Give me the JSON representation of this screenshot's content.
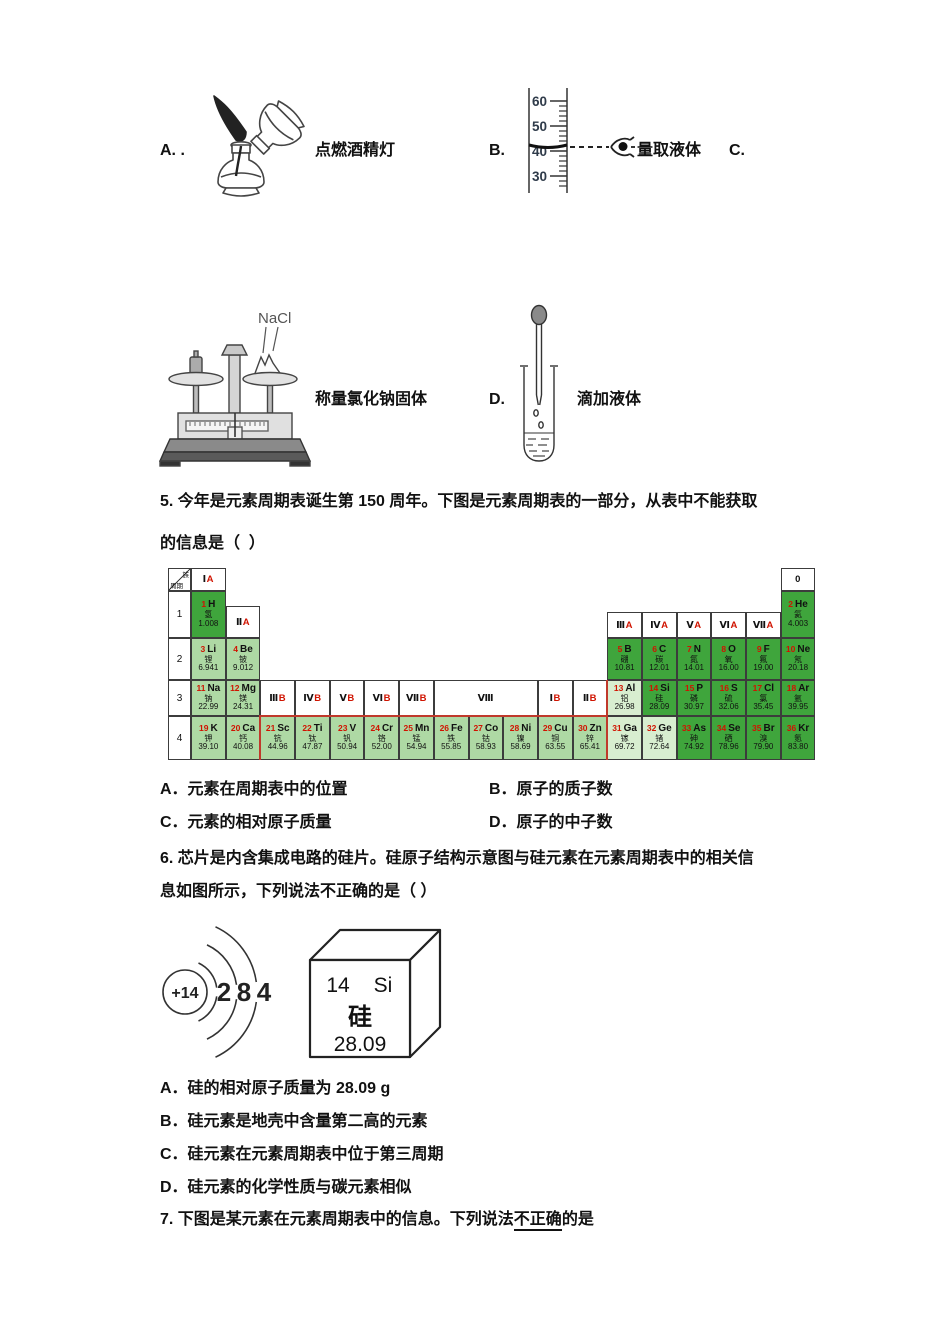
{
  "instrument_row": {
    "option_a_label": "A. .",
    "lamp_caption": "点燃酒精灯",
    "option_b_label": "B.",
    "cylinder_scale": [
      "60",
      "50",
      "40",
      "30"
    ],
    "cylinder_caption": "量取液体",
    "option_c_label": "C.",
    "balance_chemical": "NaCl",
    "balance_caption": "称量氯化钠固体",
    "option_d_label": "D.",
    "dropper_caption": "滴加液体"
  },
  "q5": {
    "stem_line1": "5. 今年是元素周期表诞生第 150 周年。下图是元素周期表的一部分，从表中不能获取",
    "stem_line2": "的信息是（  ）",
    "option_a": "A．元素在周期表中的位置",
    "option_b": "B．原子的质子数",
    "option_c": "C．元素的相对原子质量",
    "option_d": "D．原子的中子数"
  },
  "periodic_table": {
    "corner_top": "族",
    "corner_bottom": "周期",
    "periods": [
      "1",
      "2",
      "3",
      "4"
    ],
    "headers": [
      {
        "label": "Ⅰ",
        "sub": "A",
        "row": "top",
        "col": 1
      },
      {
        "label": "0",
        "row": "top",
        "col": 18
      },
      {
        "label": "Ⅱ",
        "sub": "A",
        "row": "p1",
        "col": 2
      },
      {
        "label": "Ⅲ",
        "sub": "A",
        "row": "p1",
        "col": 13
      },
      {
        "label": "Ⅳ",
        "sub": "A",
        "row": "p1",
        "col": 14
      },
      {
        "label": "Ⅴ",
        "sub": "A",
        "row": "p1",
        "col": 15
      },
      {
        "label": "Ⅵ",
        "sub": "A",
        "row": "p1",
        "col": 16
      },
      {
        "label": "Ⅶ",
        "sub": "A",
        "row": "p1",
        "col": 17
      },
      {
        "label": "Ⅲ",
        "sub": "B",
        "row": "p3",
        "col": 3
      },
      {
        "label": "Ⅳ",
        "sub": "B",
        "row": "p3",
        "col": 4
      },
      {
        "label": "Ⅴ",
        "sub": "B",
        "row": "p3",
        "col": 5
      },
      {
        "label": "Ⅵ",
        "sub": "B",
        "row": "p3",
        "col": 6
      },
      {
        "label": "Ⅶ",
        "sub": "B",
        "row": "p3",
        "col": 7
      },
      {
        "label": "Ⅷ",
        "row": "p3",
        "col": 8,
        "span": 3
      },
      {
        "label": "Ⅰ",
        "sub": "B",
        "row": "p3",
        "col": 11
      },
      {
        "label": "Ⅱ",
        "sub": "B",
        "row": "p3",
        "col": 12
      }
    ],
    "elements": [
      {
        "n": "1",
        "s": "H",
        "cn": "氢",
        "m": "1.008",
        "p": 1,
        "c": 1,
        "cat": "nm"
      },
      {
        "n": "2",
        "s": "He",
        "cn": "氦",
        "m": "4.003",
        "p": 1,
        "c": 18,
        "cat": "nm"
      },
      {
        "n": "3",
        "s": "Li",
        "cn": "锂",
        "m": "6.941",
        "p": 2,
        "c": 1,
        "cat": "m"
      },
      {
        "n": "4",
        "s": "Be",
        "cn": "铍",
        "m": "9.012",
        "p": 2,
        "c": 2,
        "cat": "m"
      },
      {
        "n": "5",
        "s": "B",
        "cn": "硼",
        "m": "10.81",
        "p": 2,
        "c": 13,
        "cat": "nm"
      },
      {
        "n": "6",
        "s": "C",
        "cn": "碳",
        "m": "12.01",
        "p": 2,
        "c": 14,
        "cat": "nm"
      },
      {
        "n": "7",
        "s": "N",
        "cn": "氮",
        "m": "14.01",
        "p": 2,
        "c": 15,
        "cat": "nm"
      },
      {
        "n": "8",
        "s": "O",
        "cn": "氧",
        "m": "16.00",
        "p": 2,
        "c": 16,
        "cat": "nm"
      },
      {
        "n": "9",
        "s": "F",
        "cn": "氟",
        "m": "19.00",
        "p": 2,
        "c": 17,
        "cat": "nm"
      },
      {
        "n": "10",
        "s": "Ne",
        "cn": "氖",
        "m": "20.18",
        "p": 2,
        "c": 18,
        "cat": "nm"
      },
      {
        "n": "11",
        "s": "Na",
        "cn": "钠",
        "m": "22.99",
        "p": 3,
        "c": 1,
        "cat": "m"
      },
      {
        "n": "12",
        "s": "Mg",
        "cn": "镁",
        "m": "24.31",
        "p": 3,
        "c": 2,
        "cat": "m"
      },
      {
        "n": "13",
        "s": "Al",
        "cn": "铝",
        "m": "26.98",
        "p": 3,
        "c": 13,
        "cat": "ml"
      },
      {
        "n": "14",
        "s": "Si",
        "cn": "硅",
        "m": "28.09",
        "p": 3,
        "c": 14,
        "cat": "nm"
      },
      {
        "n": "15",
        "s": "P",
        "cn": "磷",
        "m": "30.97",
        "p": 3,
        "c": 15,
        "cat": "nm"
      },
      {
        "n": "16",
        "s": "S",
        "cn": "硫",
        "m": "32.06",
        "p": 3,
        "c": 16,
        "cat": "nm"
      },
      {
        "n": "17",
        "s": "Cl",
        "cn": "氯",
        "m": "35.45",
        "p": 3,
        "c": 17,
        "cat": "nm"
      },
      {
        "n": "18",
        "s": "Ar",
        "cn": "氩",
        "m": "39.95",
        "p": 3,
        "c": 18,
        "cat": "nm"
      },
      {
        "n": "19",
        "s": "K",
        "cn": "钾",
        "m": "39.10",
        "p": 4,
        "c": 1,
        "cat": "m"
      },
      {
        "n": "20",
        "s": "Ca",
        "cn": "钙",
        "m": "40.08",
        "p": 4,
        "c": 2,
        "cat": "m"
      },
      {
        "n": "21",
        "s": "Sc",
        "cn": "钪",
        "m": "44.96",
        "p": 4,
        "c": 3,
        "cat": "m"
      },
      {
        "n": "22",
        "s": "Ti",
        "cn": "钛",
        "m": "47.87",
        "p": 4,
        "c": 4,
        "cat": "m"
      },
      {
        "n": "23",
        "s": "V",
        "cn": "钒",
        "m": "50.94",
        "p": 4,
        "c": 5,
        "cat": "m"
      },
      {
        "n": "24",
        "s": "Cr",
        "cn": "铬",
        "m": "52.00",
        "p": 4,
        "c": 6,
        "cat": "m"
      },
      {
        "n": "25",
        "s": "Mn",
        "cn": "锰",
        "m": "54.94",
        "p": 4,
        "c": 7,
        "cat": "m"
      },
      {
        "n": "26",
        "s": "Fe",
        "cn": "铁",
        "m": "55.85",
        "p": 4,
        "c": 8,
        "cat": "m"
      },
      {
        "n": "27",
        "s": "Co",
        "cn": "钴",
        "m": "58.93",
        "p": 4,
        "c": 9,
        "cat": "m"
      },
      {
        "n": "28",
        "s": "Ni",
        "cn": "镍",
        "m": "58.69",
        "p": 4,
        "c": 10,
        "cat": "m"
      },
      {
        "n": "29",
        "s": "Cu",
        "cn": "铜",
        "m": "63.55",
        "p": 4,
        "c": 11,
        "cat": "m"
      },
      {
        "n": "30",
        "s": "Zn",
        "cn": "锌",
        "m": "65.41",
        "p": 4,
        "c": 12,
        "cat": "m"
      },
      {
        "n": "31",
        "s": "Ga",
        "cn": "镓",
        "m": "69.72",
        "p": 4,
        "c": 13,
        "cat": "ml"
      },
      {
        "n": "32",
        "s": "Ge",
        "cn": "锗",
        "m": "72.64",
        "p": 4,
        "c": 14,
        "cat": "ml"
      },
      {
        "n": "33",
        "s": "As",
        "cn": "砷",
        "m": "74.92",
        "p": 4,
        "c": 15,
        "cat": "nm"
      },
      {
        "n": "34",
        "s": "Se",
        "cn": "硒",
        "m": "78.96",
        "p": 4,
        "c": 16,
        "cat": "nm"
      },
      {
        "n": "35",
        "s": "Br",
        "cn": "溴",
        "m": "79.90",
        "p": 4,
        "c": 17,
        "cat": "nm"
      },
      {
        "n": "36",
        "s": "Kr",
        "cn": "氪",
        "m": "83.80",
        "p": 4,
        "c": 18,
        "cat": "nm"
      }
    ],
    "colors": {
      "nonmetal_bg": "#3fa53c",
      "metal_bg": "#aed9a4",
      "light_metal_bg": "#d8eed0",
      "number_red": "#d01300",
      "group_letter_red": "#d01300",
      "frame_red": "#c0392b",
      "grid_line": "#3c3c3c"
    }
  },
  "q6": {
    "stem_line1": "6. 芯片是内含集成电路的硅片。硅原子结构示意图与硅元素在元素周期表中的相关信",
    "stem_line2": "息如图所示，下列说法不正确的是（ ）",
    "option_a": "A．硅的相对原子质量为 28.09 g",
    "option_b": "B．硅元素是地壳中含量第二高的元素",
    "option_c": "C．硅元素在元素周期表中位于第三周期",
    "option_d": "D．硅元素的化学性质与碳元素相似",
    "atom": {
      "nucleus_charge": "+14",
      "shell_electrons": [
        "2",
        "8",
        "4"
      ]
    },
    "cell": {
      "atomic_number": "14",
      "symbol": "Si",
      "name": "硅",
      "mass": "28.09"
    }
  },
  "q7": {
    "stem_prefix": "7. 下图是某元素在元素周期表中的信息。下列说法",
    "stem_underlined": "不正确",
    "stem_suffix": "的是"
  }
}
